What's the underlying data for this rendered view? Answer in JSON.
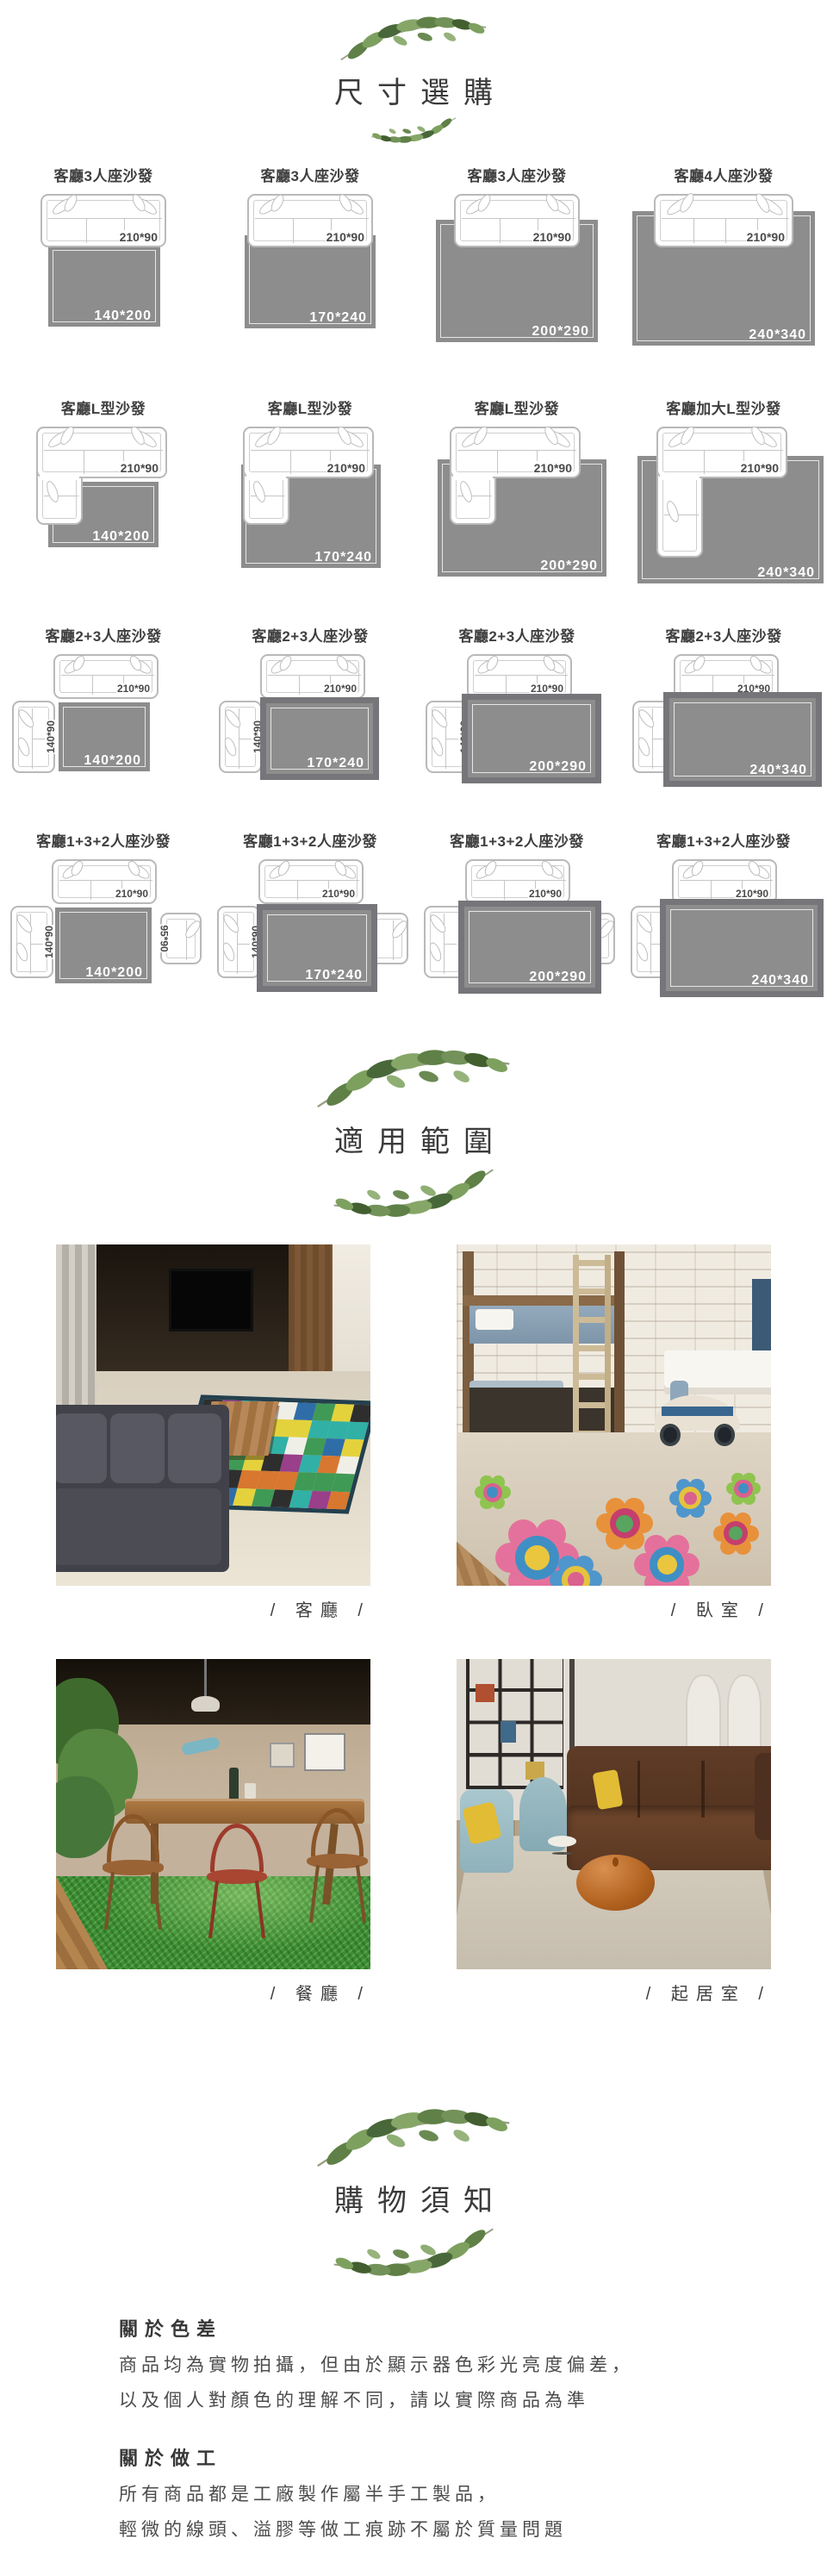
{
  "size_section": {
    "title": "尺寸選購",
    "items": [
      {
        "label": "客廳3人座沙發",
        "type": "three",
        "i": 0,
        "sofa": "210*90",
        "rug": "140*200"
      },
      {
        "label": "客廳3人座沙發",
        "type": "three",
        "i": 1,
        "sofa": "210*90",
        "rug": "170*240"
      },
      {
        "label": "客廳3人座沙發",
        "type": "three",
        "i": 2,
        "sofa": "210*90",
        "rug": "200*290"
      },
      {
        "label": "客廳4人座沙發",
        "type": "four",
        "i": 3,
        "sofa": "210*90",
        "rug": "240*340"
      },
      {
        "label": "客廳L型沙發",
        "type": "l",
        "i": 0,
        "sofa": "210*90",
        "rug": "140*200"
      },
      {
        "label": "客廳L型沙發",
        "type": "l",
        "i": 1,
        "sofa": "210*90",
        "rug": "170*240"
      },
      {
        "label": "客廳L型沙發",
        "type": "l",
        "i": 2,
        "sofa": "210*90",
        "rug": "200*290"
      },
      {
        "label": "客廳加大L型沙發",
        "type": "l",
        "i": 3,
        "big": true,
        "sofa": "210*90",
        "rug": "240*340"
      },
      {
        "label": "客廳2+3人座沙發",
        "type": "c23",
        "i": 0,
        "sofa": "210*90",
        "left": "140*90",
        "rug": "140*200"
      },
      {
        "label": "客廳2+3人座沙發",
        "type": "c23",
        "i": 1,
        "sofa": "210*90",
        "left": "140*90",
        "rug": "170*240"
      },
      {
        "label": "客廳2+3人座沙發",
        "type": "c23",
        "i": 2,
        "sofa": "210*90",
        "left": "140*90",
        "rug": "200*290"
      },
      {
        "label": "客廳2+3人座沙發",
        "type": "c23",
        "i": 3,
        "sofa": "210*90",
        "left": "140*90",
        "rug": "240*340"
      },
      {
        "label": "客廳1+3+2人座沙發",
        "type": "c132",
        "i": 0,
        "sofa": "210*90",
        "left": "140*90",
        "right": "95*90",
        "rug": "140*200"
      },
      {
        "label": "客廳1+3+2人座沙發",
        "type": "c132",
        "i": 1,
        "sofa": "210*90",
        "left": "140*90",
        "right": "95*90",
        "rug": "170*240"
      },
      {
        "label": "客廳1+3+2人座沙發",
        "type": "c132",
        "i": 2,
        "sofa": "210*90",
        "left": "140*90",
        "right": "95*90",
        "rug": "200*290"
      },
      {
        "label": "客廳1+3+2人座沙發",
        "type": "c132",
        "i": 3,
        "sofa": "210*90",
        "left": "140*90",
        "right": "95*90",
        "rug": "240*340"
      }
    ]
  },
  "usage_section": {
    "title": "適用範圍",
    "photos": [
      {
        "caption": "/ 客廳 /",
        "scene": "living-room"
      },
      {
        "caption": "/ 臥室 /",
        "scene": "bedroom"
      },
      {
        "caption": "/ 餐廳 /",
        "scene": "dining-room"
      },
      {
        "caption": "/ 起居室 /",
        "scene": "sitting-room"
      }
    ]
  },
  "notice_section": {
    "title": "購物須知",
    "blocks": [
      {
        "heading": "關於色差",
        "lines": [
          "商品均為實物拍攝，但由於顯示器色彩光亮度偏差，",
          "以及個人對顏色的理解不同，請以實際商品為準"
        ]
      },
      {
        "heading": "關於做工",
        "lines": [
          "所有商品都是工廠製作屬半手工製品，",
          "輕微的線頭、溢膠等做工痕跡不屬於質量問題"
        ]
      }
    ]
  },
  "colors": {
    "rug_gray": "#8d8d8d",
    "rug_frame": "#76767a",
    "sofa_outline": "#b9b9b9",
    "text_dark": "#3c3c3c",
    "leaf_greens": [
      "#5f8046",
      "#7da05f",
      "#49683a",
      "#86a668"
    ],
    "checker": [
      "#2e2e2e",
      "#e4d23c",
      "#3f9a55",
      "#2f6da8",
      "#efefe8",
      "#d8772f",
      "#31b0a6",
      "#9a3f8a"
    ],
    "flowers": [
      {
        "petal": "#e4719c",
        "ring": "#3f8fc4",
        "center": "#eac63e"
      },
      {
        "petal": "#e8913b",
        "ring": "#c43f6d",
        "center": "#57a55f"
      },
      {
        "petal": "#4f96cc",
        "ring": "#e4c23e",
        "center": "#d9618e"
      },
      {
        "petal": "#8fc44f",
        "ring": "#d9618e",
        "center": "#3f8fc4"
      }
    ]
  }
}
